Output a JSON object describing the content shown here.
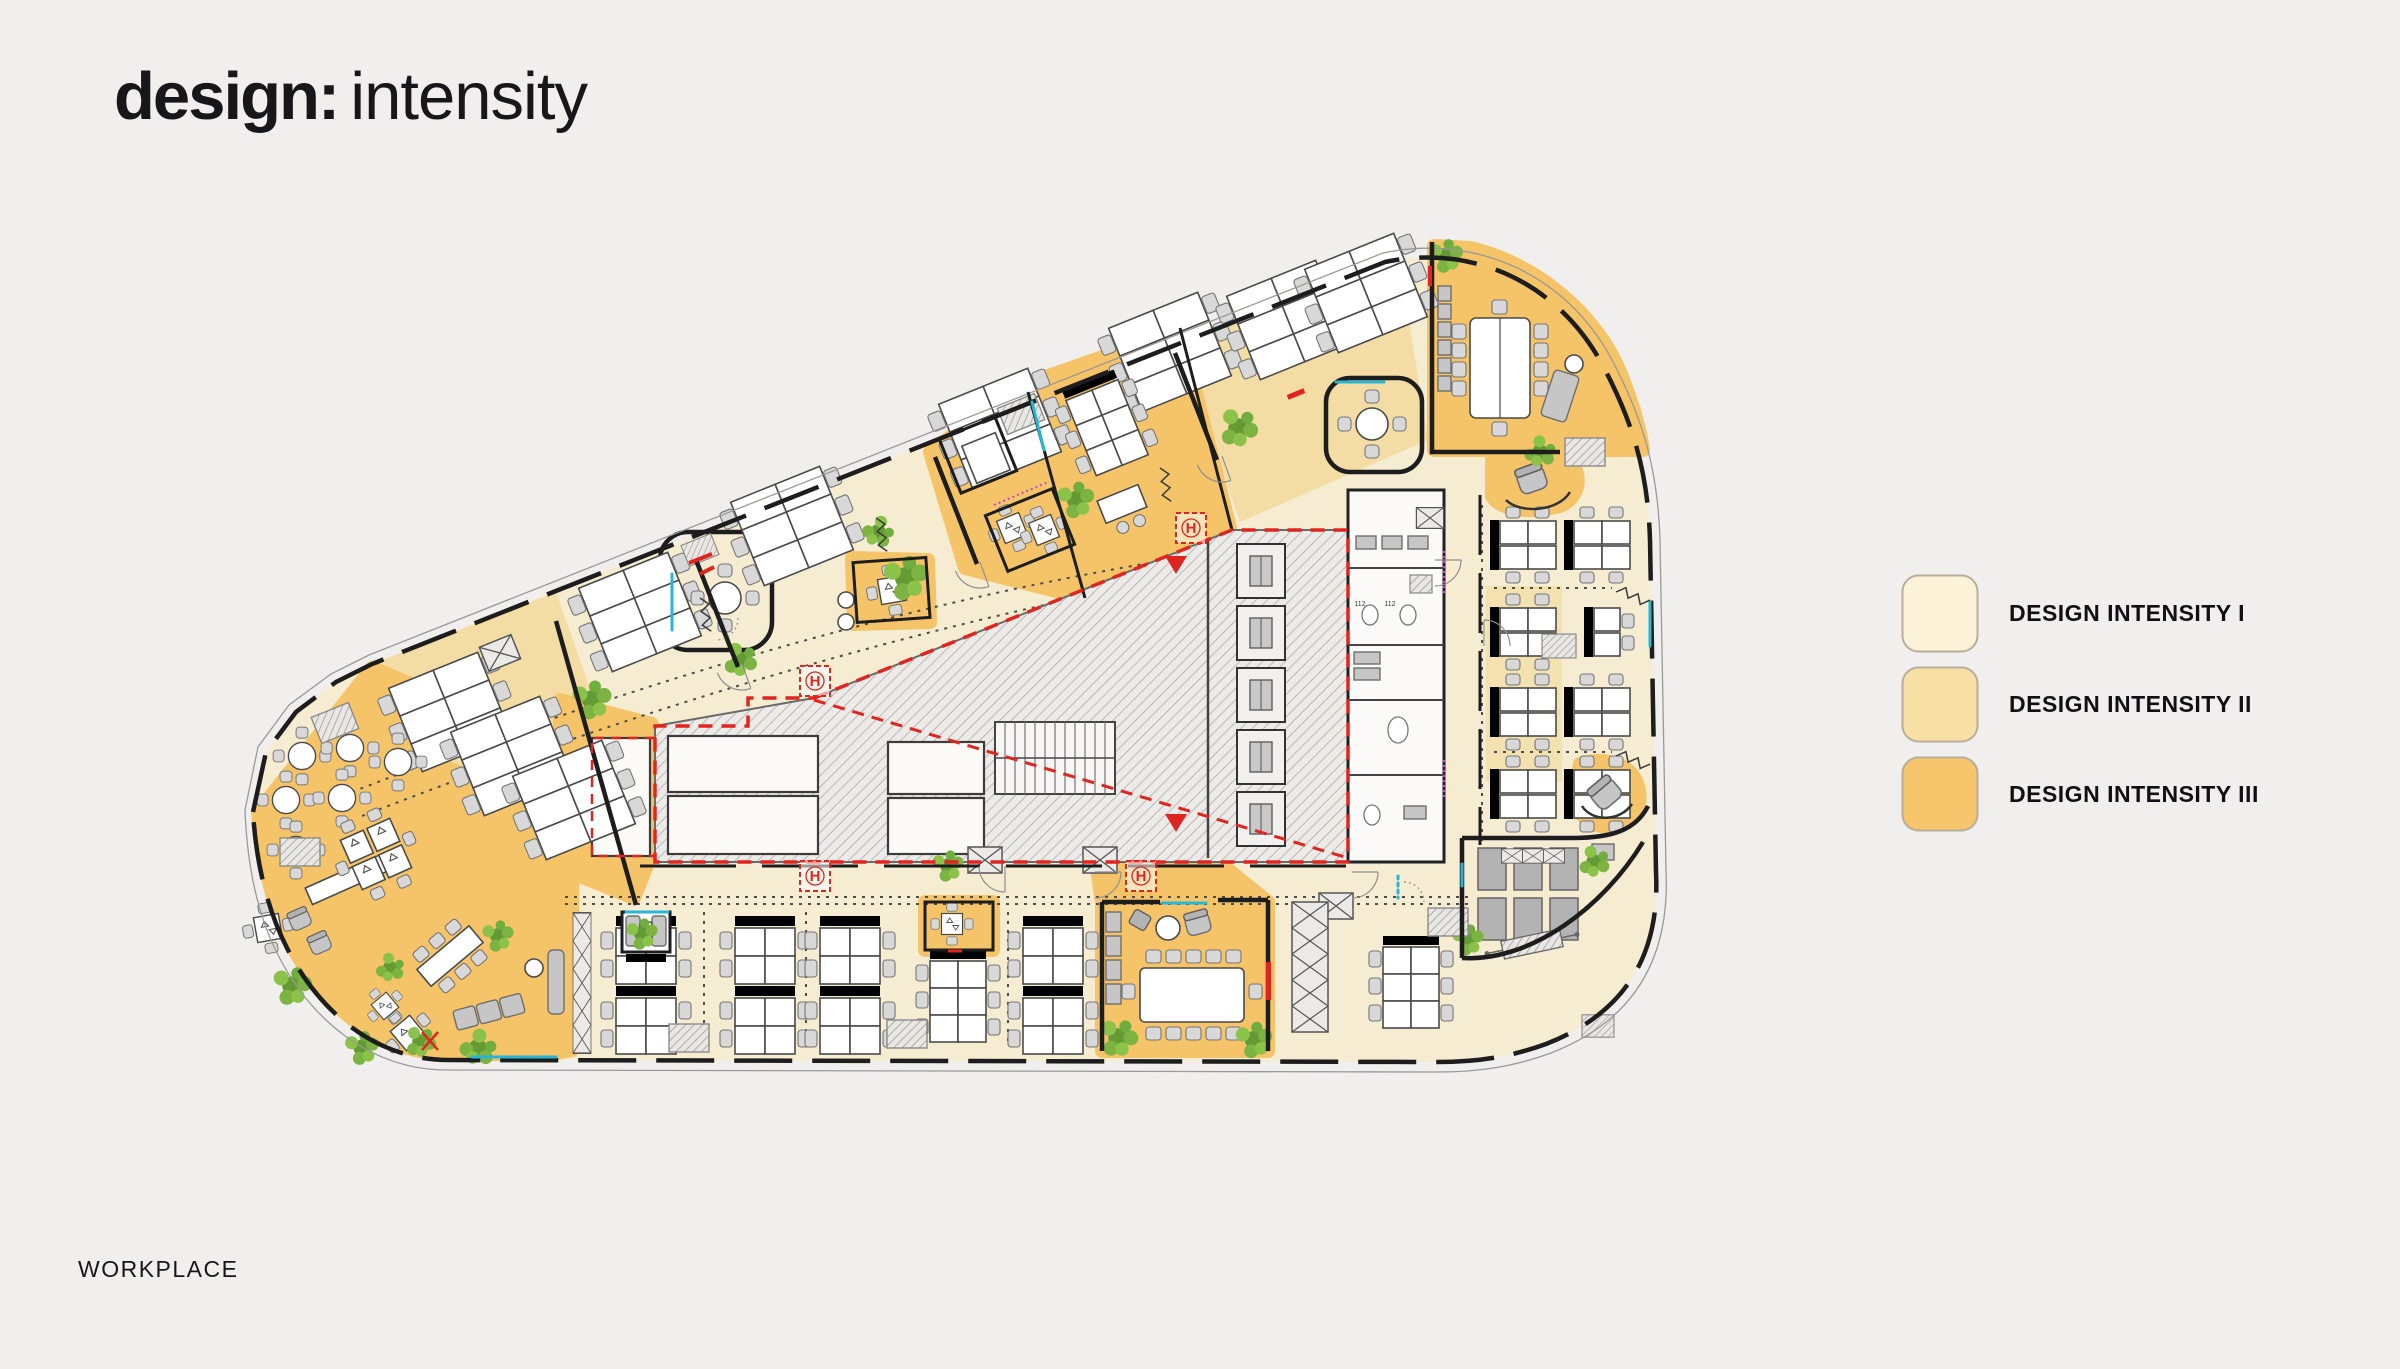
{
  "slide": {
    "background_color": "#F0EFED"
  },
  "title": {
    "bold": "design:",
    "regular": "intensity"
  },
  "legend": {
    "items": [
      {
        "label": "DESIGN INTENSITY I",
        "color": "#FCF2D8"
      },
      {
        "label": "DESIGN INTENSITY II",
        "color": "#F8E0A5"
      },
      {
        "label": "DESIGN INTENSITY III",
        "color": "#F7C66C"
      }
    ]
  },
  "floorplan": {
    "h_marker": "H",
    "room_label": "112",
    "zone_colors": {
      "intensity_1": "#F6ECD2",
      "intensity_2": "#F3DDA4",
      "intensity_3": "#F6C468"
    },
    "accent_colors": {
      "wall": "#1D1D1D",
      "red": "#E02520",
      "cyan": "#27B6D6",
      "magenta": "#CC44CC",
      "plant_green": "#7CB342"
    }
  },
  "footer": {
    "label": "WORKPLACE"
  }
}
